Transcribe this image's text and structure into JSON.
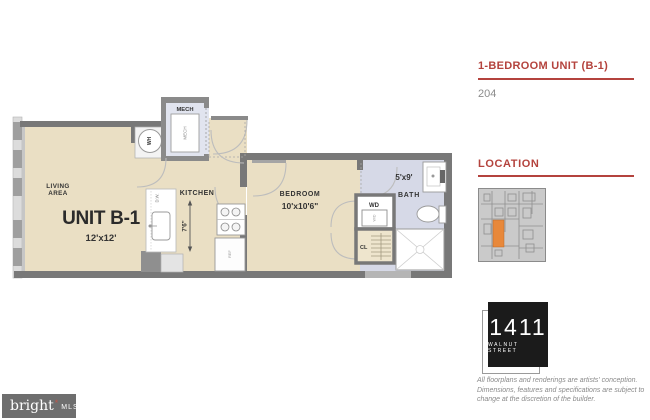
{
  "colors": {
    "accent_red": "#b4433d",
    "floor_beige": "#eadfc4",
    "bath_lavender": "#d6d9e7",
    "wall_gray": "#787878",
    "highlight_orange": "#e8883a",
    "logo_black": "#1b1b1b",
    "watermark_gray": "#6e6e6e"
  },
  "sidebar": {
    "unit_title": "1-BEDROOM UNIT (B-1)",
    "unit_number": "204",
    "location_heading": "LOCATION",
    "building_logo": {
      "number": "1411",
      "street": "WALNUT STREET"
    },
    "disclaimer": {
      "line1": "All floorplans and renderings are artists' conception.",
      "line2": "Dimensions, features and specifications are subject to",
      "line3": "change at the discretion of the builder."
    }
  },
  "floorplan": {
    "unit_name": "UNIT B-1",
    "living": {
      "label_line1": "LIVING",
      "label_line2": "AREA",
      "dimensions": "12'x12'"
    },
    "kitchen": {
      "label": "KITCHEN",
      "dimensions": "7'6\"",
      "dishwasher": "D.W.",
      "refrigerator": "REF"
    },
    "bedroom": {
      "label": "BEDROOM",
      "dimensions": "10'x10'6\""
    },
    "bath": {
      "label": "BATH",
      "dimensions": "5'x9'"
    },
    "mech": {
      "label": "MECH",
      "unit_label": "MECH"
    },
    "water_heater": "WH",
    "washer_dryer": {
      "label": "WD",
      "unit_label": "W/D"
    },
    "closet": "CL"
  },
  "watermark": {
    "brand": "bright",
    "star": "*",
    "suffix": "MLS"
  }
}
